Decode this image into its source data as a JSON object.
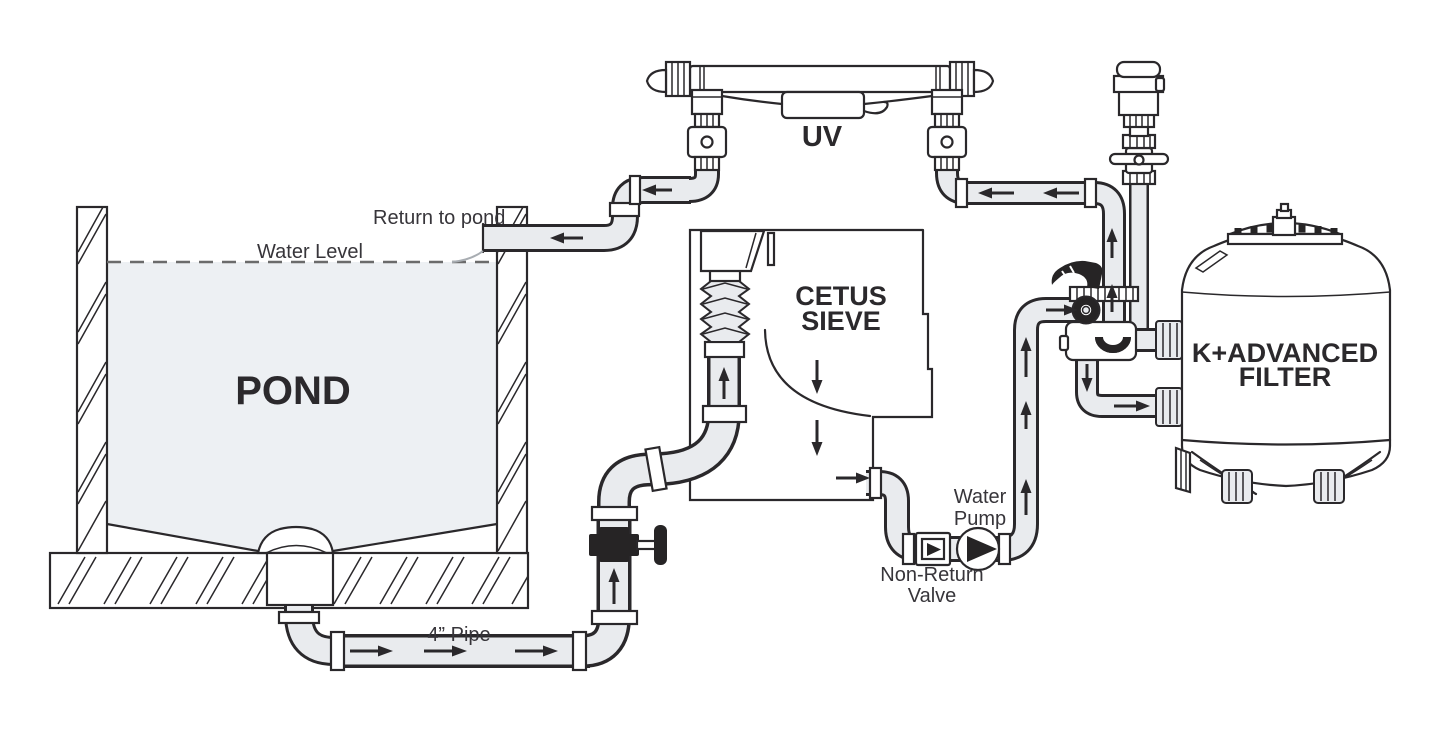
{
  "title": "Pond filtration system diagram",
  "labels": {
    "pond": "POND",
    "water_level": "Water Level",
    "return_to_pond": "Return to pond",
    "four_inch_pipe": "4” Pipe",
    "uv": "UV",
    "cetus_line1": "CETUS",
    "cetus_line2": "SIEVE",
    "water_pump_line1": "Water",
    "water_pump_line2": "Pump",
    "non_return_line1": "Non-Return",
    "non_return_line2": "Valve",
    "filter_line1": "K+ADVANCED",
    "filter_line2": "FILTER"
  },
  "icons": {
    "flow_arrows": "arrow-icon",
    "pump": "pump-impeller-icon",
    "non_return_valve": "check-valve-icon"
  },
  "colors": {
    "line": "#2a282b",
    "pipe_fill": "#e9ebee",
    "water_fill": "#edf0f3",
    "dark_valve": "#262425",
    "background": "#ffffff"
  }
}
